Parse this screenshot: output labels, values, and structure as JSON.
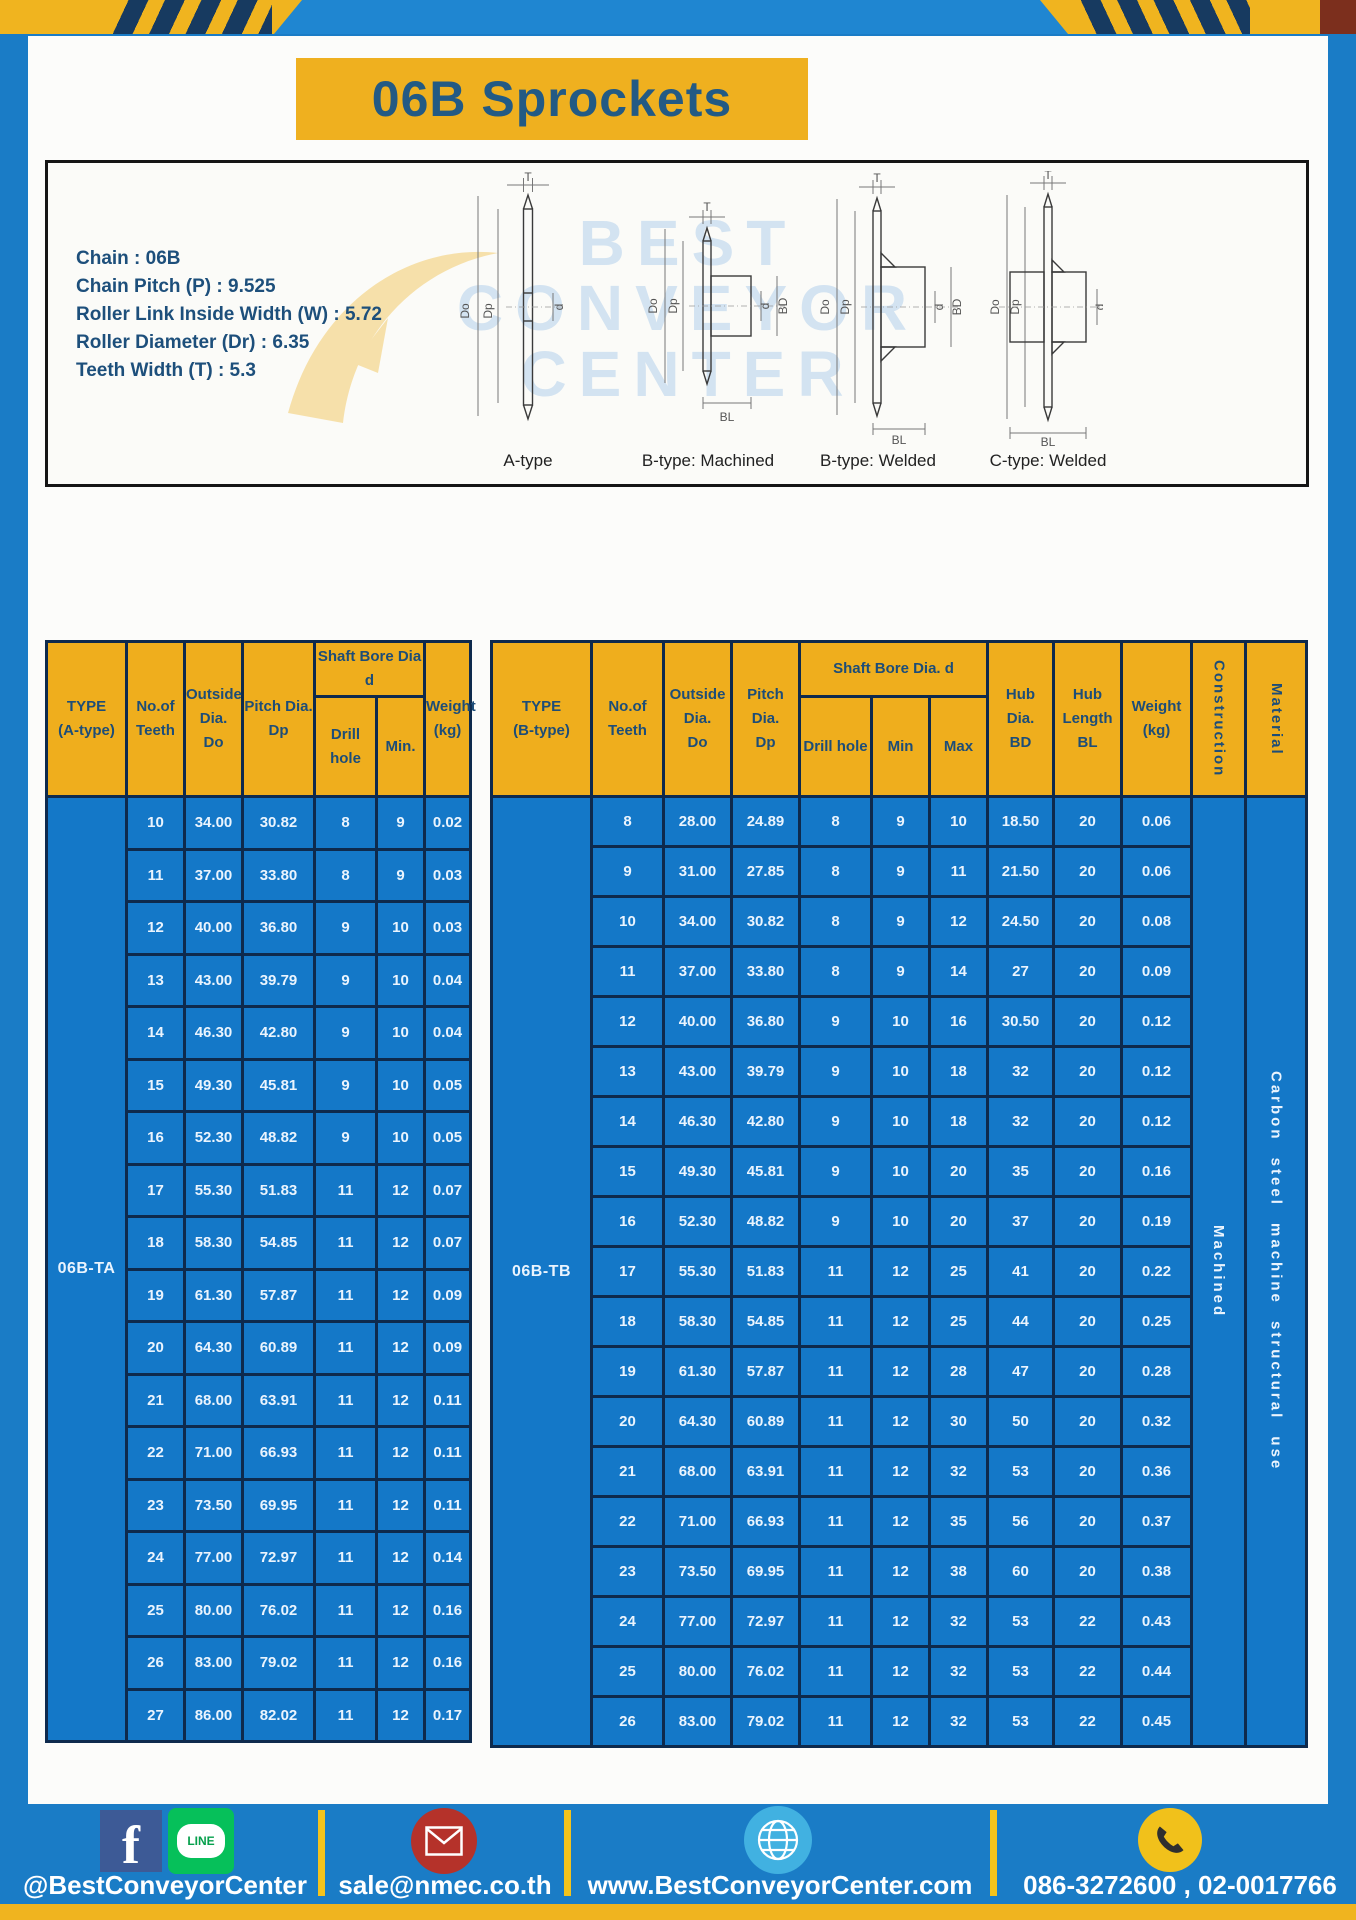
{
  "header": {
    "title": "06B Sprockets"
  },
  "specs": [
    "Chain : 06B",
    "Chain Pitch (P) : 9.525",
    "Roller Link Inside Width (W) : 5.72",
    "Roller Diameter (Dr) : 6.35",
    "Teeth Width (T) : 5.3"
  ],
  "diagram": {
    "watermark": [
      "BEST",
      "CONVEYOR",
      "CENTER"
    ],
    "captions": [
      "A-type",
      "B-type: Machined",
      "B-type: Welded",
      "C-type: Welded"
    ],
    "dims": {
      "t": "T",
      "do": "Do",
      "dp": "Dp",
      "d": "d",
      "bd": "BD",
      "bl": "BL"
    }
  },
  "table_a": {
    "type_label": "06B-TA",
    "headers": {
      "type": "TYPE\n(A-type)",
      "teeth": "No.of\nTeeth",
      "outside": "Outside\nDia.\nDo",
      "pitch": "Pitch Dia.\nDp",
      "bore_group": "Shaft Bore Dia d",
      "drill": "Drill hole",
      "min": "Min.",
      "weight": "Weight\n(kg)"
    },
    "rows": [
      [
        "10",
        "34.00",
        "30.82",
        "8",
        "9",
        "0.02"
      ],
      [
        "11",
        "37.00",
        "33.80",
        "8",
        "9",
        "0.03"
      ],
      [
        "12",
        "40.00",
        "36.80",
        "9",
        "10",
        "0.03"
      ],
      [
        "13",
        "43.00",
        "39.79",
        "9",
        "10",
        "0.04"
      ],
      [
        "14",
        "46.30",
        "42.80",
        "9",
        "10",
        "0.04"
      ],
      [
        "15",
        "49.30",
        "45.81",
        "9",
        "10",
        "0.05"
      ],
      [
        "16",
        "52.30",
        "48.82",
        "9",
        "10",
        "0.05"
      ],
      [
        "17",
        "55.30",
        "51.83",
        "11",
        "12",
        "0.07"
      ],
      [
        "18",
        "58.30",
        "54.85",
        "11",
        "12",
        "0.07"
      ],
      [
        "19",
        "61.30",
        "57.87",
        "11",
        "12",
        "0.09"
      ],
      [
        "20",
        "64.30",
        "60.89",
        "11",
        "12",
        "0.09"
      ],
      [
        "21",
        "68.00",
        "63.91",
        "11",
        "12",
        "0.11"
      ],
      [
        "22",
        "71.00",
        "66.93",
        "11",
        "12",
        "0.11"
      ],
      [
        "23",
        "73.50",
        "69.95",
        "11",
        "12",
        "0.11"
      ],
      [
        "24",
        "77.00",
        "72.97",
        "11",
        "12",
        "0.14"
      ],
      [
        "25",
        "80.00",
        "76.02",
        "11",
        "12",
        "0.16"
      ],
      [
        "26",
        "83.00",
        "79.02",
        "11",
        "12",
        "0.16"
      ],
      [
        "27",
        "86.00",
        "82.02",
        "11",
        "12",
        "0.17"
      ]
    ]
  },
  "table_b": {
    "type_label": "06B-TB",
    "construction": "Machined",
    "material": "Carbon steel machine structural use",
    "headers": {
      "type": "TYPE\n(B-type)",
      "teeth": "No.of\nTeeth",
      "outside": "Outside\nDia.\nDo",
      "pitch": "Pitch\nDia.\nDp",
      "bore_group": "Shaft Bore Dia. d",
      "drill": "Drill hole",
      "min": "Min",
      "max": "Max",
      "hub_dia": "Hub\nDia.\nBD",
      "hub_len": "Hub\nLength\nBL",
      "weight": "Weight\n(kg)",
      "construction": "Construction",
      "material": "Material"
    },
    "rows": [
      [
        "8",
        "28.00",
        "24.89",
        "8",
        "9",
        "10",
        "18.50",
        "20",
        "0.06"
      ],
      [
        "9",
        "31.00",
        "27.85",
        "8",
        "9",
        "11",
        "21.50",
        "20",
        "0.06"
      ],
      [
        "10",
        "34.00",
        "30.82",
        "8",
        "9",
        "12",
        "24.50",
        "20",
        "0.08"
      ],
      [
        "11",
        "37.00",
        "33.80",
        "8",
        "9",
        "14",
        "27",
        "20",
        "0.09"
      ],
      [
        "12",
        "40.00",
        "36.80",
        "9",
        "10",
        "16",
        "30.50",
        "20",
        "0.12"
      ],
      [
        "13",
        "43.00",
        "39.79",
        "9",
        "10",
        "18",
        "32",
        "20",
        "0.12"
      ],
      [
        "14",
        "46.30",
        "42.80",
        "9",
        "10",
        "18",
        "32",
        "20",
        "0.12"
      ],
      [
        "15",
        "49.30",
        "45.81",
        "9",
        "10",
        "20",
        "35",
        "20",
        "0.16"
      ],
      [
        "16",
        "52.30",
        "48.82",
        "9",
        "10",
        "20",
        "37",
        "20",
        "0.19"
      ],
      [
        "17",
        "55.30",
        "51.83",
        "11",
        "12",
        "25",
        "41",
        "20",
        "0.22"
      ],
      [
        "18",
        "58.30",
        "54.85",
        "11",
        "12",
        "25",
        "44",
        "20",
        "0.25"
      ],
      [
        "19",
        "61.30",
        "57.87",
        "11",
        "12",
        "28",
        "47",
        "20",
        "0.28"
      ],
      [
        "20",
        "64.30",
        "60.89",
        "11",
        "12",
        "30",
        "50",
        "20",
        "0.32"
      ],
      [
        "21",
        "68.00",
        "63.91",
        "11",
        "12",
        "32",
        "53",
        "20",
        "0.36"
      ],
      [
        "22",
        "71.00",
        "66.93",
        "11",
        "12",
        "35",
        "56",
        "20",
        "0.37"
      ],
      [
        "23",
        "73.50",
        "69.95",
        "11",
        "12",
        "38",
        "60",
        "20",
        "0.38"
      ],
      [
        "24",
        "77.00",
        "72.97",
        "11",
        "12",
        "32",
        "53",
        "22",
        "0.43"
      ],
      [
        "25",
        "80.00",
        "76.02",
        "11",
        "12",
        "32",
        "53",
        "22",
        "0.44"
      ],
      [
        "26",
        "83.00",
        "79.02",
        "11",
        "12",
        "32",
        "53",
        "22",
        "0.45"
      ]
    ]
  },
  "footer": {
    "social_handle": "@BestConveyorCenter",
    "line_label": "LINE",
    "facebook_letter": "f",
    "email": "sale@nmec.co.th",
    "website": "www.BestConveyorCenter.com",
    "phones": "086-3272600 , 02-0017766",
    "icons": [
      "facebook-icon",
      "line-icon",
      "email-icon",
      "globe-icon",
      "phone-icon"
    ]
  },
  "colors": {
    "page_blue": "#1a7cc6",
    "table_blue": "#1478c8",
    "gold": "#efb01f",
    "navy_text": "#1d4d78",
    "border_navy": "#0e2a4d",
    "maroon_corner": "#7c2f1d"
  }
}
